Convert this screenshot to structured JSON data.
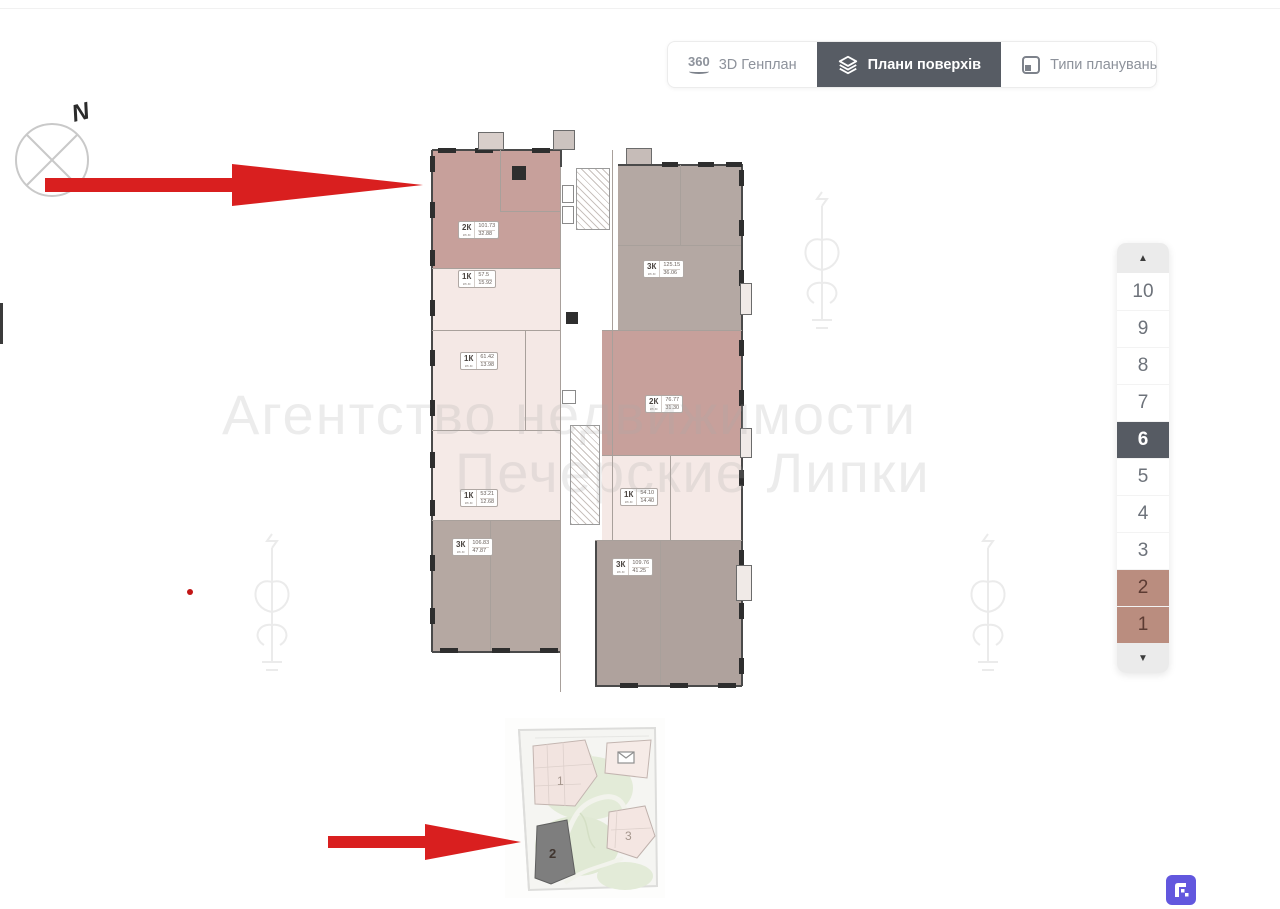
{
  "tabs": {
    "genplan": {
      "label": "3D Генплан",
      "icon_text": "360"
    },
    "floors": {
      "label": "Плани поверхів"
    },
    "types": {
      "label": "Типи планувань"
    }
  },
  "compass": {
    "north": "N"
  },
  "floor_selector": {
    "up": "▲",
    "down": "▼",
    "floors": [
      "10",
      "9",
      "8",
      "7",
      "6",
      "5",
      "4",
      "3",
      "2",
      "1"
    ],
    "selected": "6"
  },
  "floorplan": {
    "unit": "кв.м",
    "apartments": [
      {
        "type": "2К",
        "area": "101.73",
        "living": "32.88"
      },
      {
        "type": "1К",
        "area": "57.5",
        "living": "15.92"
      },
      {
        "type": "1К",
        "area": "61.42",
        "living": "13.98"
      },
      {
        "type": "1К",
        "area": "53.21",
        "living": "12.68"
      },
      {
        "type": "3К",
        "area": "106.83",
        "living": "47.87"
      },
      {
        "type": "3К",
        "area": "125.15",
        "living": "36.06"
      },
      {
        "type": "2К",
        "area": "76.77",
        "living": "31.30"
      },
      {
        "type": "1К",
        "area": "54.10",
        "living": "14.40"
      },
      {
        "type": "3К",
        "area": "109.76",
        "living": "41.25"
      }
    ]
  },
  "watermark": {
    "line1": "Агентство недвижимости",
    "line2": "Печерские Липки"
  },
  "siteplan": {
    "building1": "1",
    "building2": "2",
    "building3": "3"
  },
  "colors": {
    "accent_red": "#d91f1f",
    "active_tab": "#575c64",
    "floor_selected": "#565b63",
    "floor_rose": "#ba8d7f",
    "room_rose": "#c7a09b",
    "room_pale": "#f5e9e6",
    "room_greige": "#b4a8a3",
    "logo_purple": "#6257de"
  }
}
